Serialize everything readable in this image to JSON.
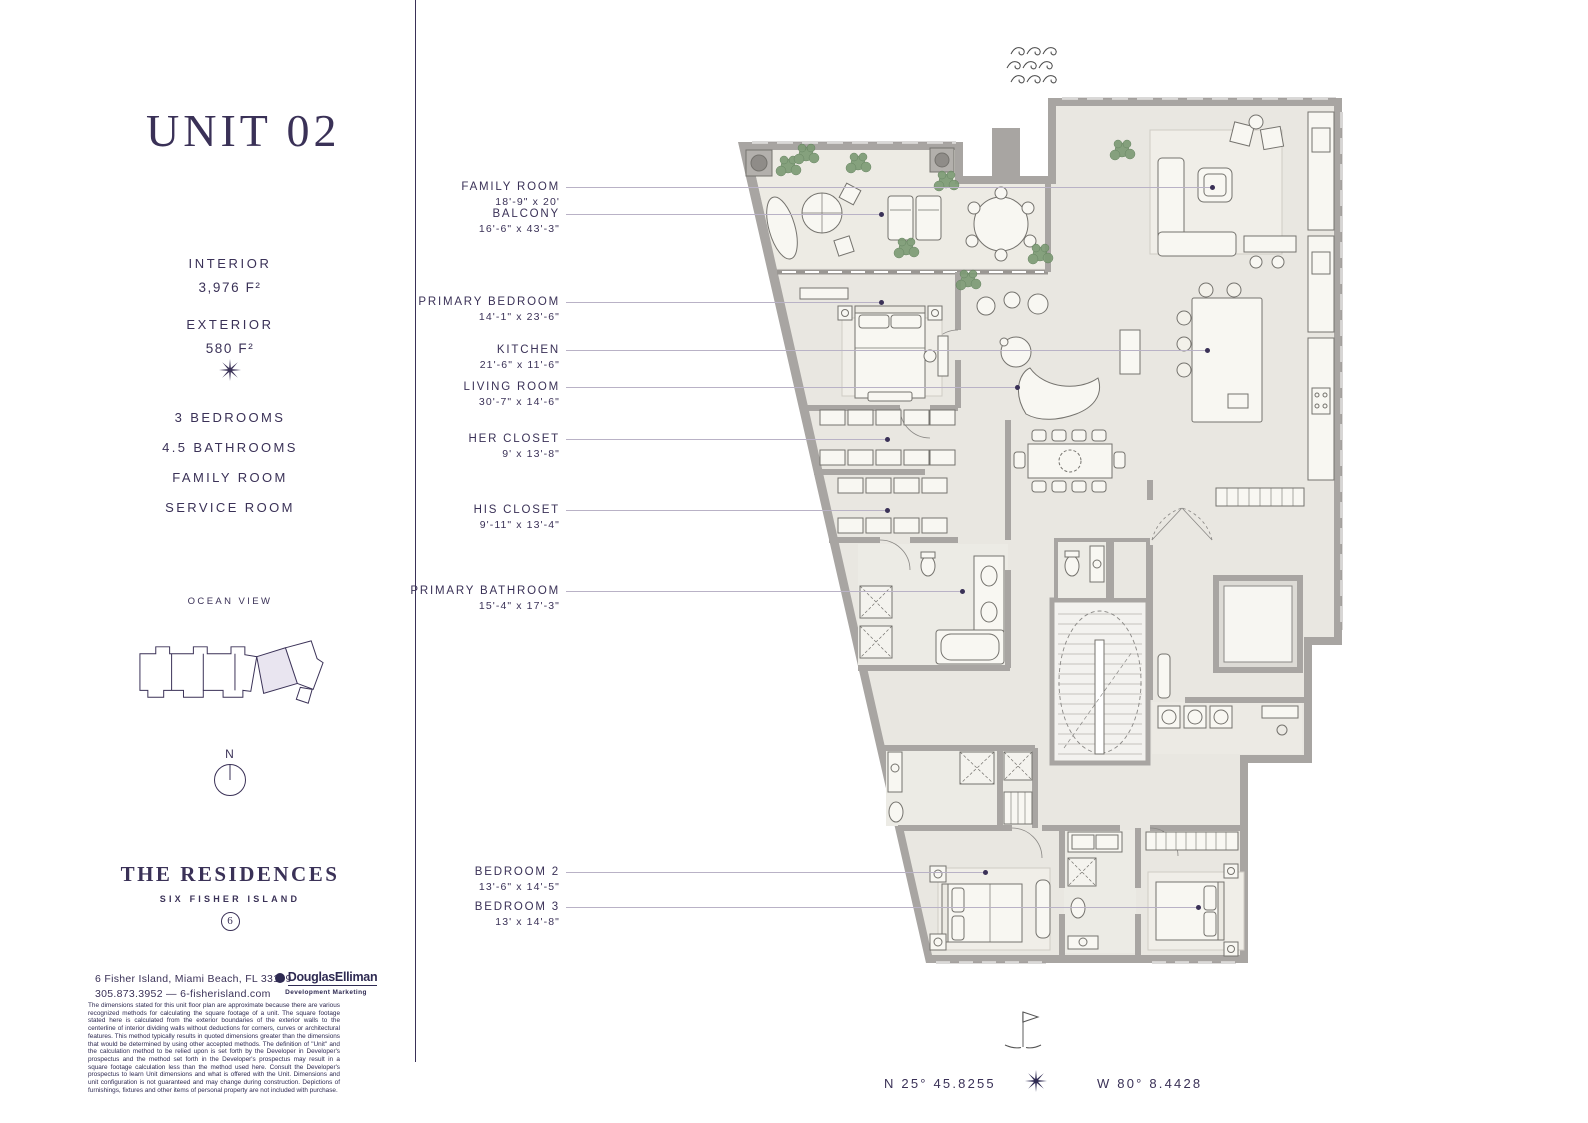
{
  "sidebar": {
    "unit_title": "UNIT 02",
    "stats": [
      {
        "label": "INTERIOR",
        "value": "3,976 F²"
      },
      {
        "label": "EXTERIOR",
        "value": "580 F²"
      }
    ],
    "features": [
      "3 BEDROOMS",
      "4.5 BATHROOMS",
      "FAMILY ROOM",
      "SERVICE ROOM"
    ],
    "keyplan_title": "OCEAN VIEW",
    "compass_label": "N",
    "brand": {
      "name": "THE RESIDENCES",
      "subtitle": "SIX FISHER ISLAND",
      "monogram": "6"
    },
    "contact": {
      "address": "6 Fisher Island, Miami Beach, FL 33109",
      "phone_web": "305.873.3952 — 6-fisherisland.com"
    },
    "broker": {
      "name": "DouglasElliman",
      "tagline": "Development Marketing"
    },
    "disclaimer": "The dimensions stated for this unit floor plan are approximate because there are various recognized methods for calculating the square footage of a unit. The square footage stated here is calculated from the exterior boundaries of the exterior walls to the centerline of interior dividing walls without deductions for corners, curves or architectural features. This method typically results in quoted dimensions greater than the dimensions that would be determined by using other accepted methods. The definition of \"Unit\" and the calculation method to be relied upon is set forth by the Developer in Developer's prospectus and the method set forth in the Developer's prospectus may result in a square footage calculation less than the method used here. Consult the Developer's prospectus to learn Unit dimensions and what is offered with the Unit. Dimensions and unit configuration is not guaranteed and may change during construction. Depictions of furnishings, fixtures and other items of personal property are not included with purchase."
  },
  "plan": {
    "labels": [
      {
        "name": "FAMILY ROOM",
        "dims": "18'-9\" x 20'"
      },
      {
        "name": "BALCONY",
        "dims": "16'-6\" x 43'-3\""
      },
      {
        "name": "PRIMARY BEDROOM",
        "dims": "14'-1\" x 23'-6\""
      },
      {
        "name": "KITCHEN",
        "dims": "21'-6\" x 11'-6\""
      },
      {
        "name": "LIVING ROOM",
        "dims": "30'-7\" x 14'-6\""
      },
      {
        "name": "HER CLOSET",
        "dims": "9' x 13'-8\""
      },
      {
        "name": "HIS CLOSET",
        "dims": "9'-11\" x 13'-4\""
      },
      {
        "name": "PRIMARY BATHROOM",
        "dims": "15'-4\" x 17'-3\""
      },
      {
        "name": "BEDROOM 2",
        "dims": "13'-6\" x 14'-5\""
      },
      {
        "name": "BEDROOM 3",
        "dims": "13' x 14'-8\""
      }
    ]
  },
  "footer": {
    "latitude": "N 25° 45.8255",
    "longitude": "W 80° 8.4428"
  },
  "colors": {
    "accent": "#3a3157",
    "leader_line": "#b9b2c6",
    "wall": "#a8a5a2",
    "floor": "#e9e7e1",
    "unit_highlight": "#e9e5f0",
    "plant": "#7d9b75"
  }
}
